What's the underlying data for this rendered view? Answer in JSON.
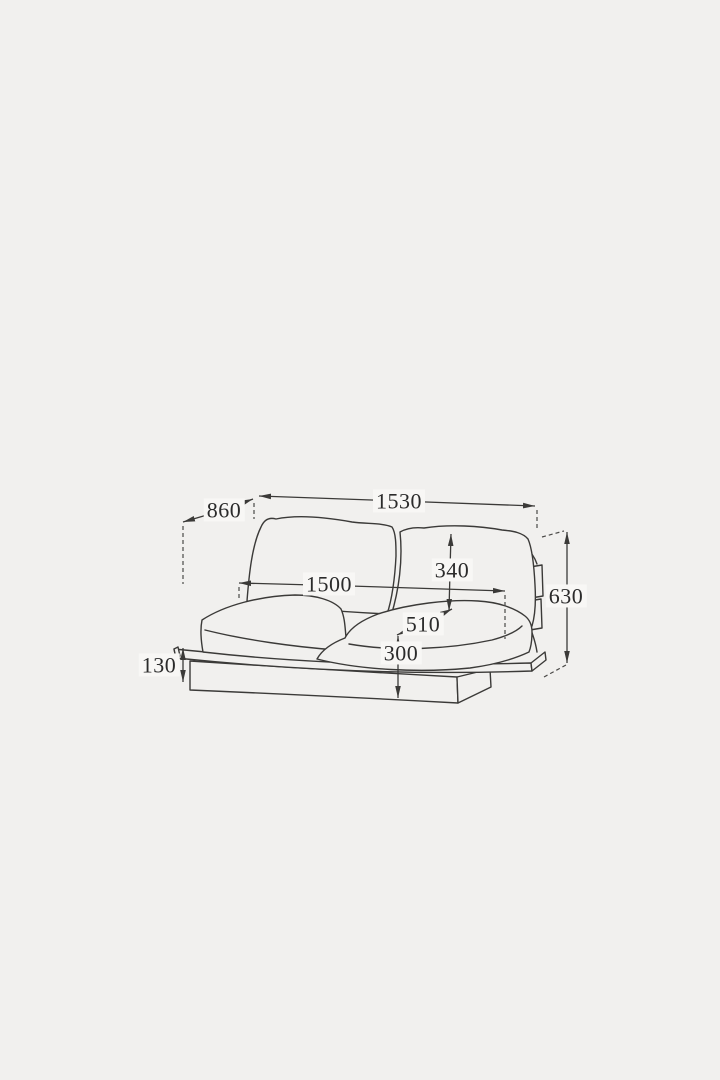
{
  "diagram": {
    "name": "Two-seat sofa dimension drawing",
    "colors": {
      "background": "#f1f0ee",
      "line": "#3b3a38",
      "label_background": "#f8f7f5",
      "label_text": "#2b2b2b"
    },
    "dimensions": {
      "overall_width": "1530",
      "overall_depth": "860",
      "seat_width": "1500",
      "back_cushion_height": "340",
      "seat_depth": "510",
      "seat_height": "300",
      "overall_back_height": "630",
      "base_height": "130"
    }
  }
}
